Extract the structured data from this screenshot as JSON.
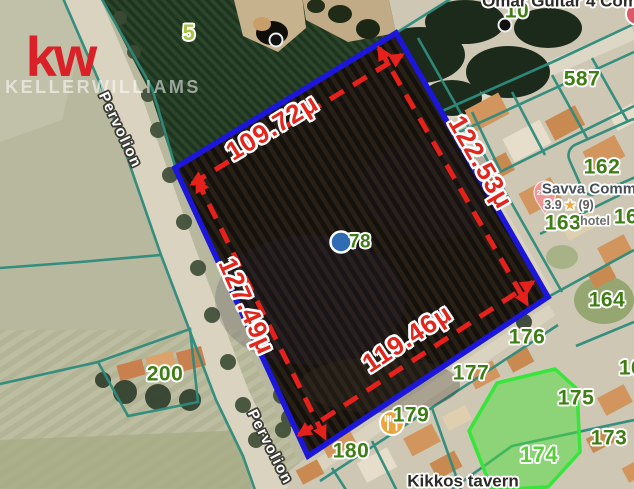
{
  "brand": {
    "logo": "kw",
    "name": "KELLERWILLIAMS"
  },
  "measurements": {
    "top": "109.72μ",
    "right": "122.53μ",
    "left": "127.49μ",
    "bottom": "119.46μ"
  },
  "parcels": {
    "p5": "5",
    "p10": "10",
    "p78": "78",
    "p162": "162",
    "p163": "163",
    "p164": "164",
    "p173": "173",
    "p174": "174",
    "p175": "175",
    "p176": "176",
    "p177": "177",
    "p179": "179",
    "p180": "180",
    "p200": "200",
    "p587": "587",
    "p16_partial": "16"
  },
  "streets": {
    "pervolion": "Pervolion"
  },
  "pois": {
    "omar": {
      "name": "Omar Guitar 4 Com"
    },
    "savva": {
      "name": "Savva Comm",
      "rating": "3.9",
      "star": "★",
      "reviews": "(9)",
      "category": "hotel"
    },
    "kikkos": {
      "name": "Kikkos tavern"
    },
    "price_pin": {
      "label": "2.8M"
    }
  },
  "colors": {
    "boundary_blue": "#1b16da",
    "measurement_red": "#e3251c",
    "cadastral_teal": "#2e8b7c",
    "parcel_number_green": "#3e7d13",
    "highlight_parcel_green": "#37e53c",
    "brand_red": "#d92127"
  }
}
